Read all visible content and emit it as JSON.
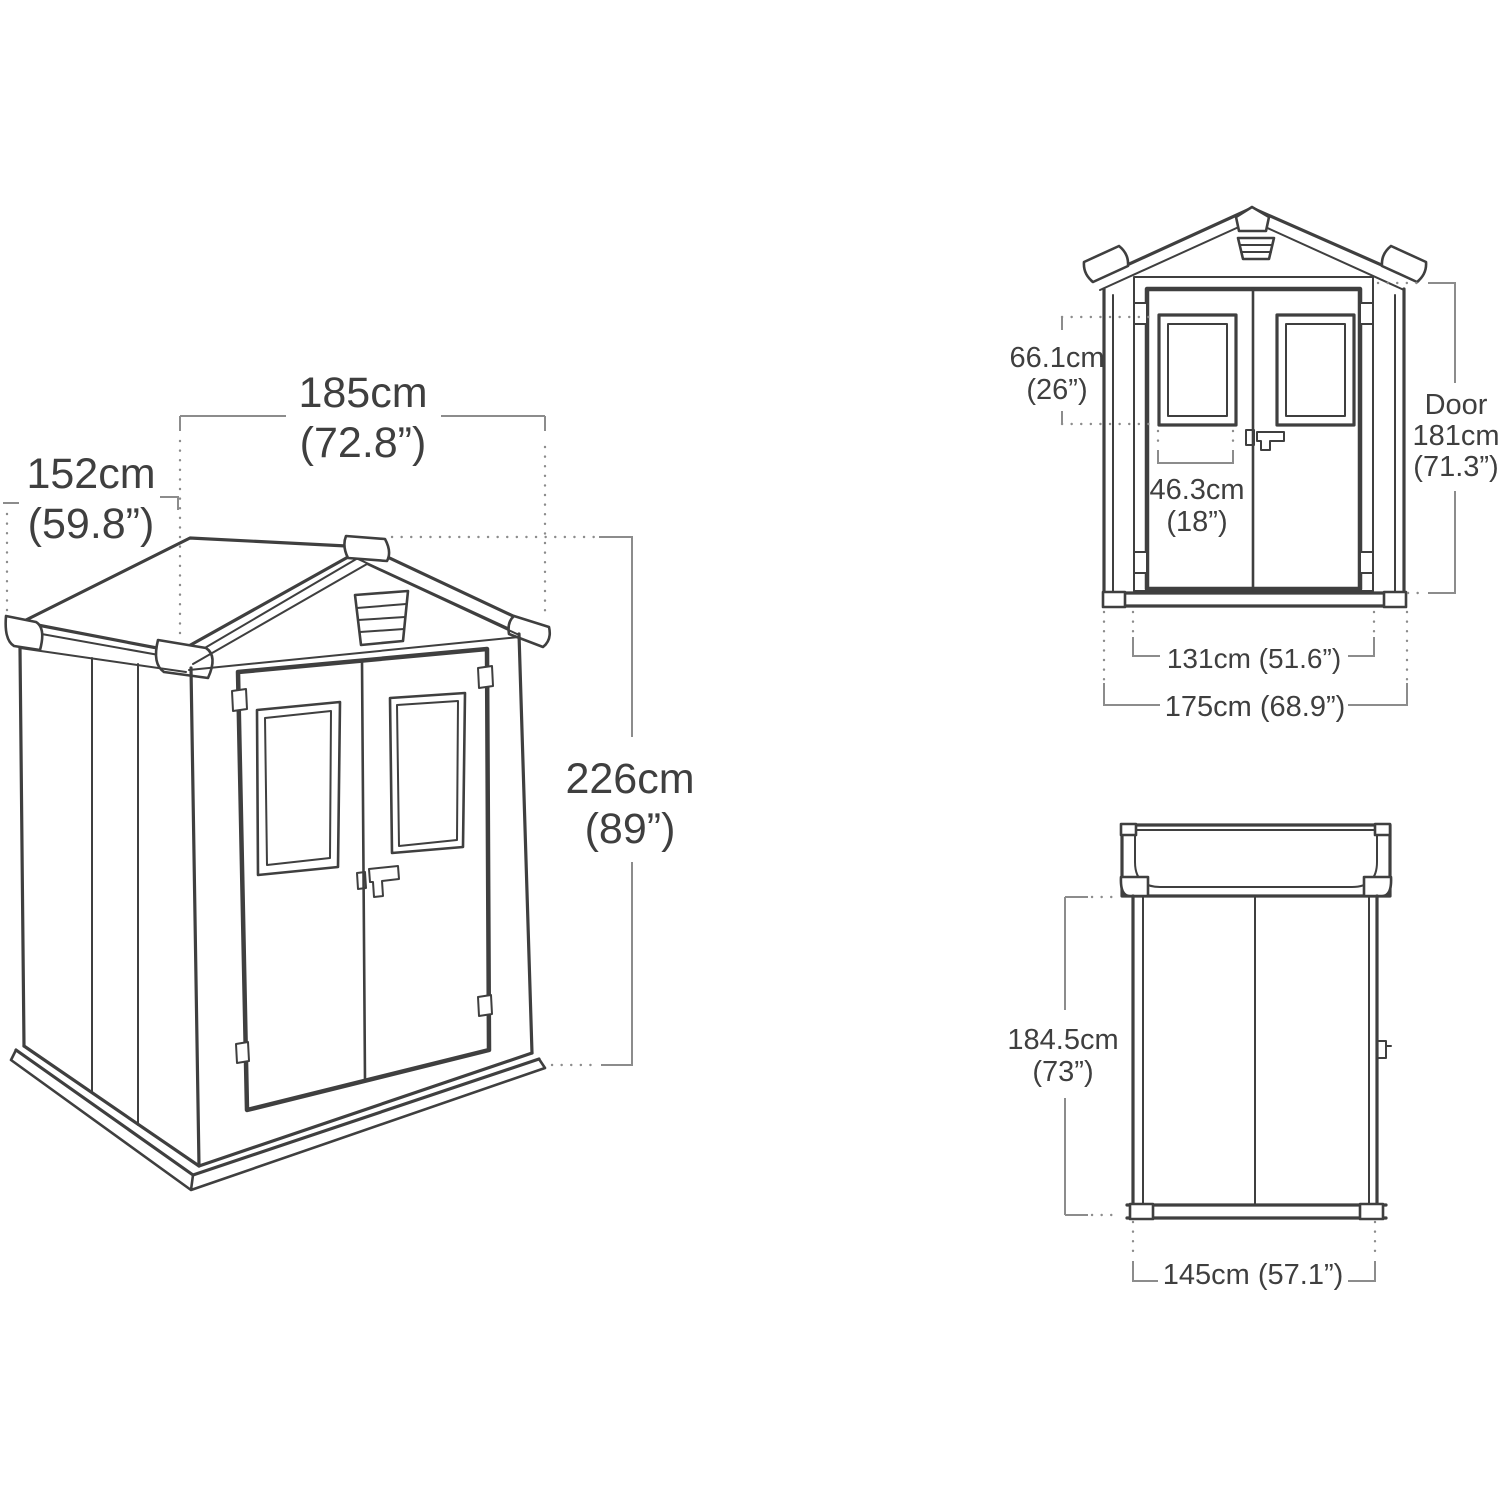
{
  "colors": {
    "line": "#3f3f3f",
    "dim_line": "#8c8c8c",
    "text": "#3f3f3f",
    "background": "#ffffff"
  },
  "views": {
    "perspective": {
      "labels": {
        "width": {
          "value": "185cm",
          "imperial": "(72.8”)"
        },
        "depth": {
          "value": "152cm",
          "imperial": "(59.8”)"
        },
        "height": {
          "value": "226cm",
          "imperial": "(89”)"
        }
      }
    },
    "front": {
      "labels": {
        "window_height": {
          "value": "66.1cm",
          "imperial": "(26”)"
        },
        "window_width": {
          "value": "46.3cm",
          "imperial": "(18”)"
        },
        "door_height": {
          "prefix": "Door",
          "value": "181cm",
          "imperial": "(71.3”)"
        },
        "door_width": {
          "value": "131cm (51.6”)"
        },
        "overall_width": {
          "value": "175cm (68.9”)"
        }
      }
    },
    "side": {
      "labels": {
        "height": {
          "value": "184.5cm",
          "imperial": "(73”)"
        },
        "width": {
          "value": "145cm (57.1”)"
        }
      }
    }
  }
}
